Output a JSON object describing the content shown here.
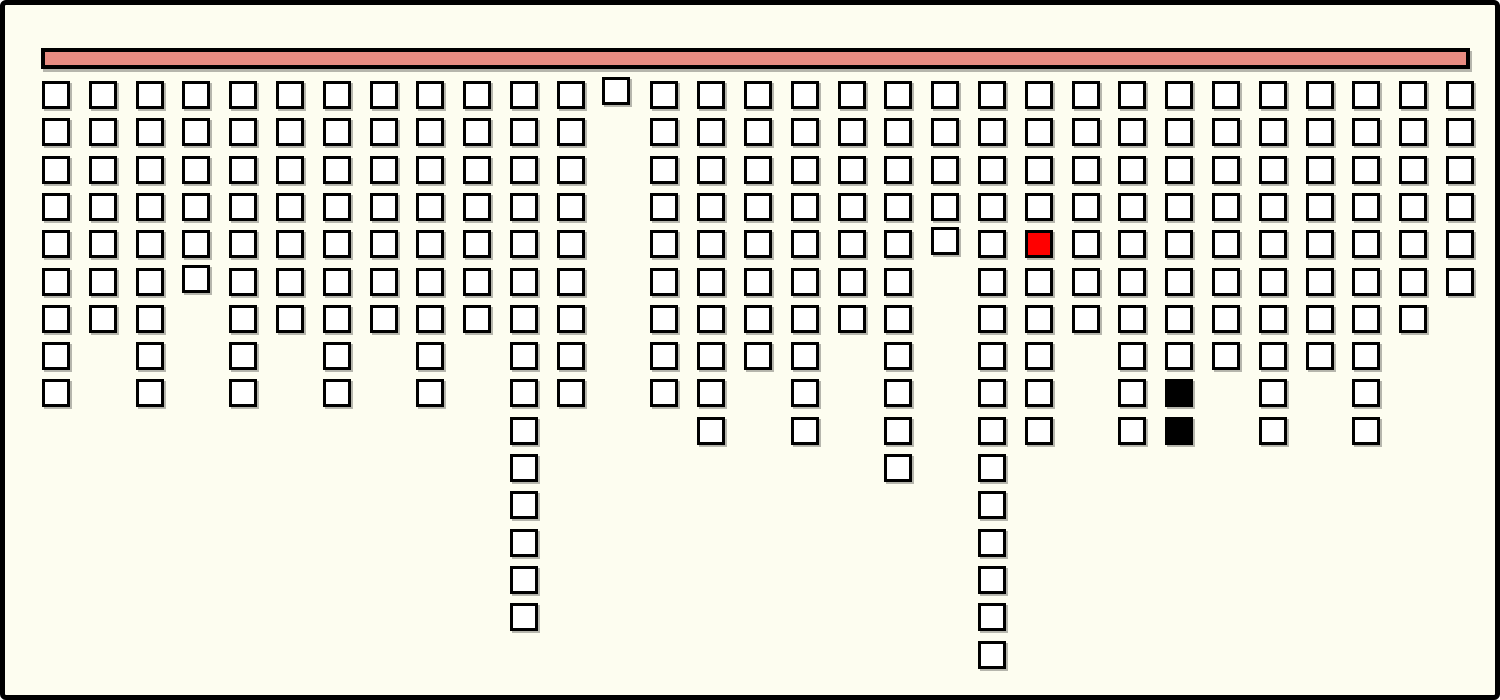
{
  "board": {
    "width": 1500,
    "height": 700,
    "background_color": "#FDFDF0",
    "frame": {
      "color": "#000000",
      "thickness": 5,
      "corner_radius": 6
    },
    "bar": {
      "x": 36,
      "y": 43,
      "width": 1429,
      "height": 21,
      "fill_color": "#E88C82",
      "border_color": "#000000",
      "border_thickness": 4
    },
    "grid": {
      "origin_x": 37,
      "origin_y": 76,
      "pitch_x": 46.8,
      "pitch_y": 37.3,
      "cell_size": 28,
      "cell_border": 3,
      "num_columns": 31,
      "max_rows": 16
    },
    "cell_colors": {
      "default_fill": "#FFFFFF",
      "border": "#000000",
      "red_fill": "#FF0000",
      "black_fill": "#000000",
      "shadow": "rgba(0,0,0,0.28)"
    },
    "column_depths": [
      9,
      7,
      9,
      6,
      9,
      7,
      9,
      7,
      9,
      7,
      15,
      9,
      1,
      9,
      10,
      8,
      10,
      7,
      11,
      5,
      16,
      10,
      7,
      10,
      10,
      8,
      10,
      8,
      10,
      7,
      6
    ],
    "special_cells": [
      {
        "col": 21,
        "row": 4,
        "color": "red"
      },
      {
        "col": 24,
        "row": 8,
        "color": "black"
      },
      {
        "col": 24,
        "row": 9,
        "color": "black"
      }
    ],
    "offset_cells": [
      {
        "col": 12,
        "row": 0,
        "dx": -2,
        "dy": -4
      },
      {
        "col": 3,
        "row": 5,
        "dx": 0,
        "dy": -3
      },
      {
        "col": 19,
        "row": 4,
        "dx": 0,
        "dy": -3
      }
    ],
    "counts": {
      "total_blocks": 266,
      "white_blocks": 263,
      "red_blocks": 1,
      "black_blocks": 2
    }
  }
}
